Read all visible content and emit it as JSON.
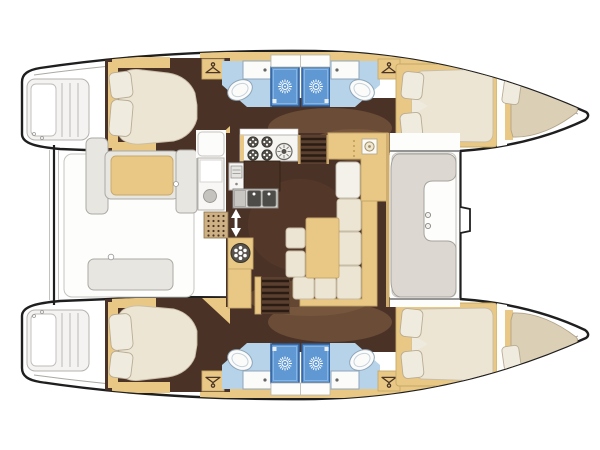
{
  "diagram": {
    "type": "yacht-floor-plan",
    "label": "Catamaran sailing yacht interior layout plan, top-down view, bow to the right",
    "vessel": "sailing catamaran",
    "cabins": 4,
    "heads": 4,
    "shower_stalls": 4,
    "forepeak_berths": 2,
    "areas": [
      {
        "name": "port-aft-cabin",
        "contents": [
          "double-bed",
          "pillows",
          "wardrobe"
        ]
      },
      {
        "name": "port-aft-head",
        "contents": [
          "toilet",
          "sink",
          "shower-stall"
        ]
      },
      {
        "name": "port-fore-head",
        "contents": [
          "toilet",
          "sink",
          "shower-stall"
        ]
      },
      {
        "name": "port-fore-cabin",
        "contents": [
          "double-bed",
          "pillows",
          "wardrobe"
        ]
      },
      {
        "name": "port-forepeak",
        "contents": [
          "single-berth",
          "pillow"
        ]
      },
      {
        "name": "starboard-aft-cabin",
        "contents": [
          "double-bed",
          "pillows",
          "wardrobe"
        ]
      },
      {
        "name": "starboard-aft-head",
        "contents": [
          "toilet",
          "sink",
          "shower-stall"
        ]
      },
      {
        "name": "starboard-fore-head",
        "contents": [
          "toilet",
          "sink",
          "shower-stall"
        ]
      },
      {
        "name": "starboard-fore-cabin",
        "contents": [
          "double-bed",
          "pillows",
          "wardrobe"
        ]
      },
      {
        "name": "starboard-forepeak",
        "contents": [
          "single-berth",
          "pillow"
        ]
      },
      {
        "name": "salon",
        "contents": [
          "galley-stove",
          "double-sink",
          "fridge",
          "l-shaped-sofa",
          "table",
          "stools",
          "nav-seat",
          "companionway-stairs-port",
          "companionway-stairs-starboard",
          "round-fixture-cabinet"
        ]
      },
      {
        "name": "aft-cockpit",
        "contents": [
          "bench-seat-cushion",
          "bench-seat",
          "side-modules"
        ]
      },
      {
        "name": "forward-cockpit",
        "contents": [
          "c-shaped-seat",
          "cup-holders"
        ]
      },
      {
        "name": "transoms",
        "contents": [
          "swim-steps-port",
          "swim-steps-starboard"
        ]
      }
    ],
    "icons": [
      "shower-rose-sunburst",
      "clothes-hanger",
      "stove-burner",
      "faucet-dot",
      "spoked-wheel"
    ]
  },
  "colors": {
    "outline_black": "#1f1f1f",
    "floor_dark": "#4b3226",
    "floor_mid": "#8a6647",
    "tan": "#e8c884",
    "tan_edge": "#c8a86a",
    "cream": "#ece5d4",
    "cream_dark": "#dbcfb6",
    "pillow": "#f0ebdf",
    "blue_floor": "#b7d3ea",
    "shower_blue": "#5f98d2",
    "shower_edge": "#2c5c99",
    "white_deck": "#fdfdfc",
    "gray_line": "#aba9a4",
    "gray_fill": "#e8e6e1",
    "wood_step": "#5b4030",
    "step_dark": "#2a1c12"
  }
}
